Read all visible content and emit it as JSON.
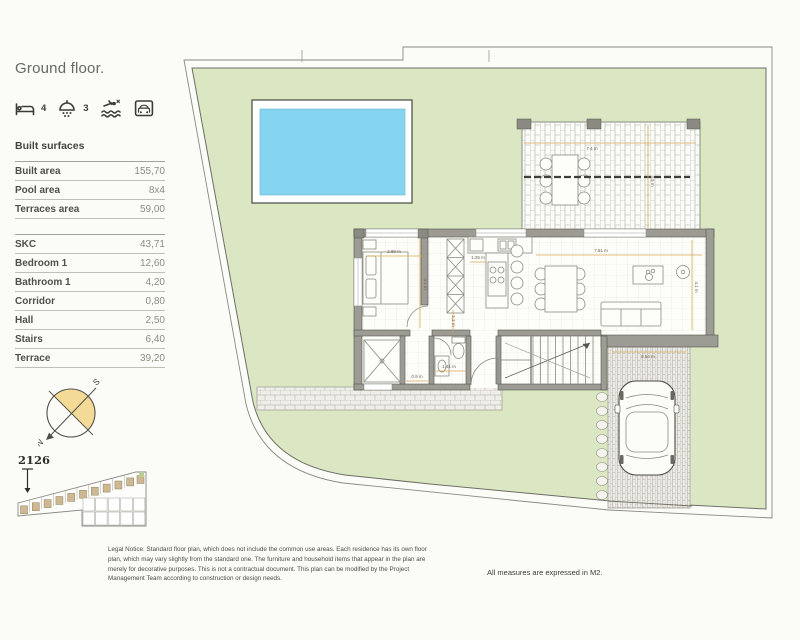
{
  "header": {
    "title": "Ground floor."
  },
  "amenities": {
    "beds": {
      "icon": "bed-icon",
      "count": "4"
    },
    "baths": {
      "icon": "shower-icon",
      "count": "3"
    },
    "pool": {
      "icon": "pool-icon"
    },
    "garage": {
      "icon": "garage-icon"
    }
  },
  "built_surfaces": {
    "heading": "Built surfaces",
    "rows": [
      {
        "label": "Built area",
        "value": "155,70"
      },
      {
        "label": "Pool area",
        "value": "8x4"
      },
      {
        "label": "Terraces area",
        "value": "59,00"
      }
    ]
  },
  "rooms": {
    "rows": [
      {
        "label": "SKC",
        "value": "43,71"
      },
      {
        "label": "Bedroom 1",
        "value": "12,60"
      },
      {
        "label": "Bathroom 1",
        "value": "4,20"
      },
      {
        "label": "Corridor",
        "value": "0,80"
      },
      {
        "label": "Hall",
        "value": "2,50"
      },
      {
        "label": "Stairs",
        "value": "6,40"
      },
      {
        "label": "Terrace",
        "value": "39,20"
      }
    ]
  },
  "compass": {
    "north": "N",
    "south": "S"
  },
  "siteplan": {
    "unit": "2126"
  },
  "plan": {
    "dims": {
      "terrace_width": "7.4 m",
      "terrace_depth": "4.5 m",
      "bedroom_width": "2.89 m",
      "bedroom_depth": "4.1 m",
      "corridor_width": "1.25 m",
      "hall_width": "1.1 m",
      "living_width": "7.81 m",
      "living_depth": "4.1 m",
      "bathroom_width": "1.41 m",
      "wc_width": "0.9 m",
      "driveway_length": "8.54 m"
    }
  },
  "footer": {
    "legal_notice": "Legal Notice: Standard floor plan, which does not include the common use areas. Each residence has its own floor plan, which may vary slightly from the standard one. The furniture and household items that appear in the plan are merely for decorative purposes. This is not a contractual document. This plan can be modified by the Project Management Team according to construction or design needs.",
    "measures_note": "All measures are expressed in M2."
  },
  "colors": {
    "lawn": "#dbe7c3",
    "pool_water": "#84d5ef",
    "compass_fill": "#f3da96",
    "wall": "#9c9c94",
    "dim_line": "#d7a855"
  }
}
